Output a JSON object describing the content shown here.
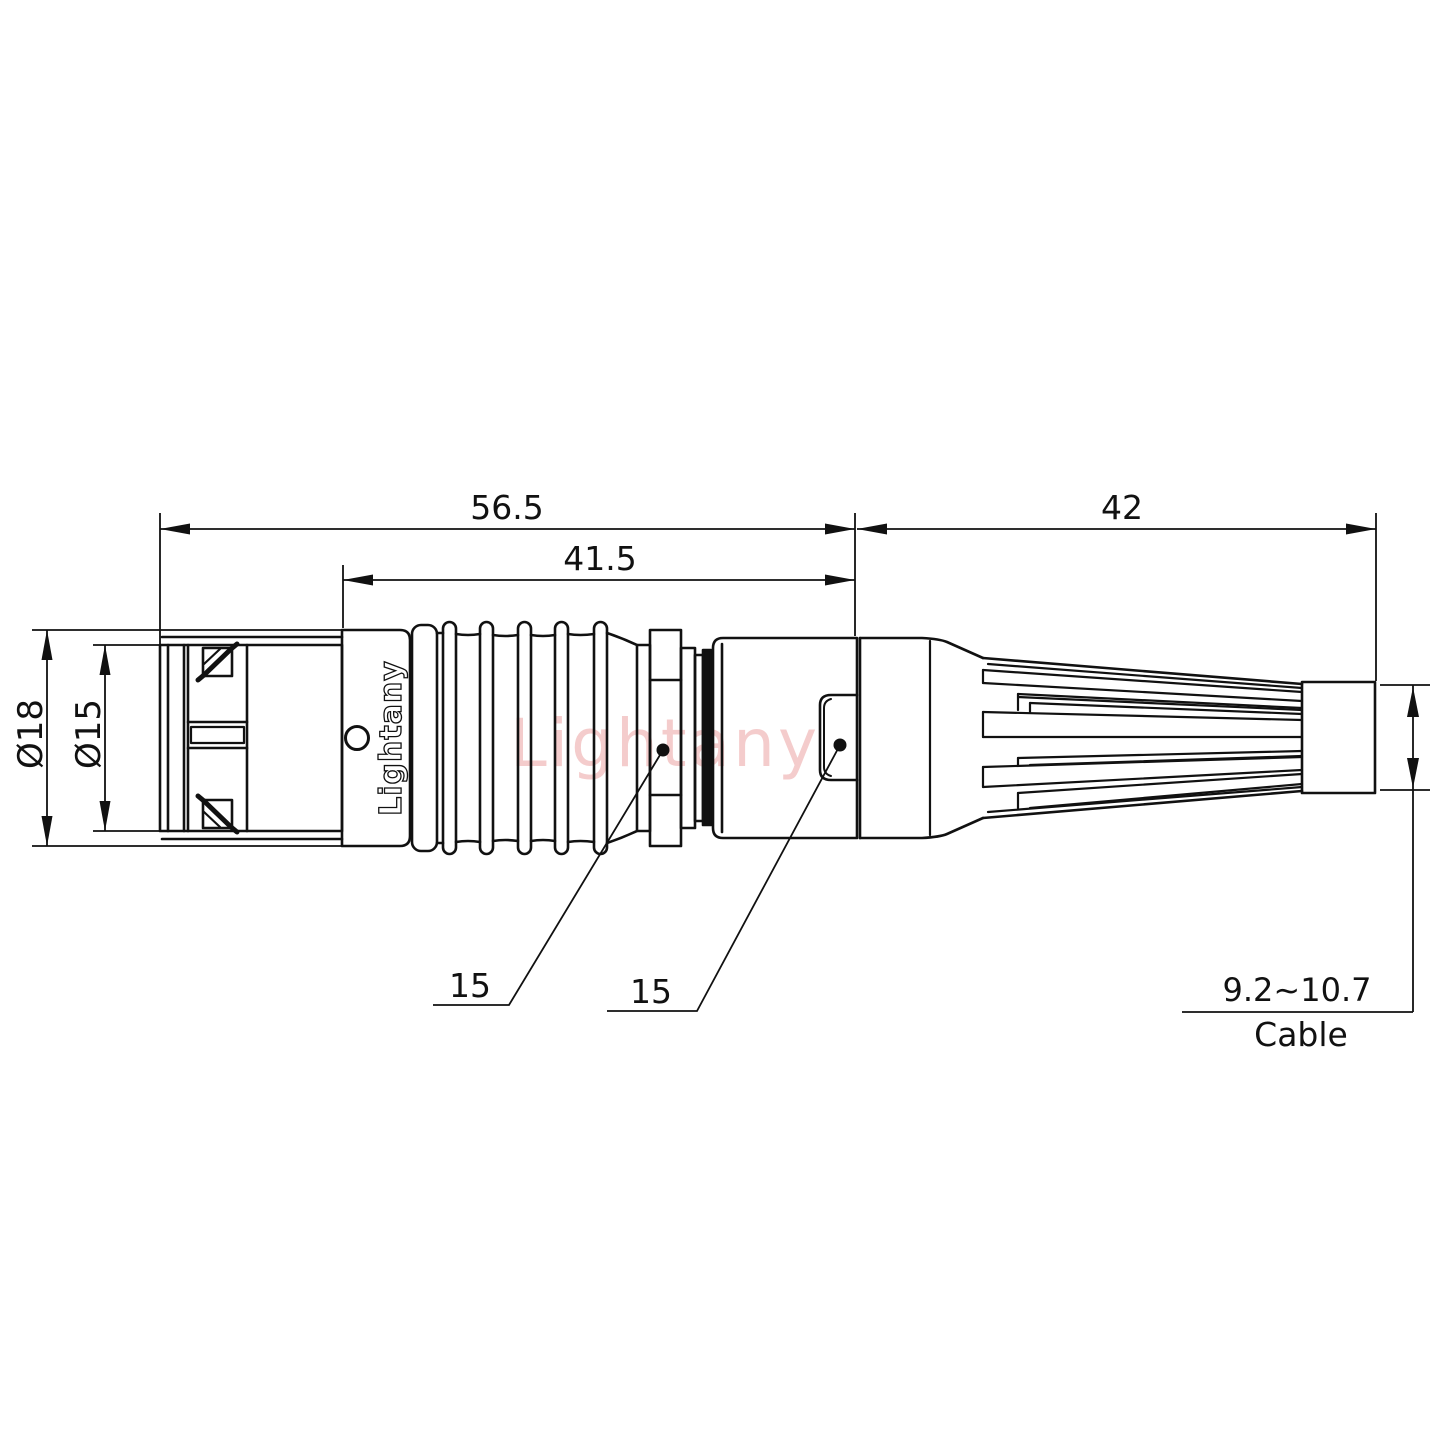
{
  "dimensions": {
    "overall_length": "56.5",
    "housing_length": "41.5",
    "boot_length": "42",
    "outer_diameter": "Ø18",
    "coupling_diameter": "Ø15",
    "wrench_flat_front": "15",
    "wrench_flat_rear": "15",
    "cable_range": "9.2~10.7",
    "cable_caption": "Cable"
  },
  "branding": {
    "body_marking": "Lightany",
    "watermark": "Lightany"
  },
  "colors": {
    "line": "#111111",
    "watermark": "#db5a5a"
  }
}
